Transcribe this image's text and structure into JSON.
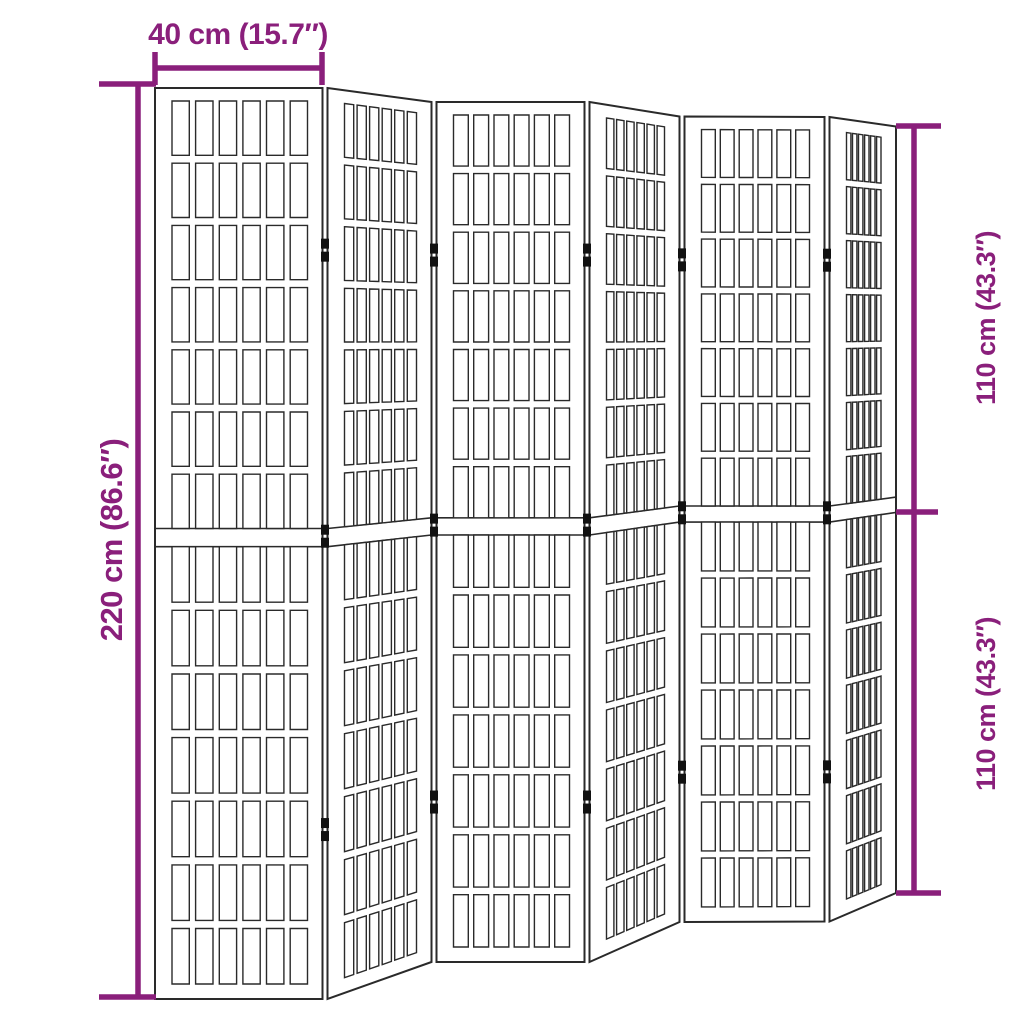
{
  "figure": {
    "title": "Room divider dimension diagram",
    "product": "Folding room divider, 6 panels, shoji lattice style",
    "background_color": "#ffffff",
    "line_color": "#2a2a2a",
    "accent_color": "#8a1f7b",
    "hinge_color": "#111111",
    "panel_count": 6,
    "hinges_per_junction": 3,
    "lattice": {
      "columns_per_panel": 6,
      "rows_per_half": 7,
      "halves_per_panel": 2
    }
  },
  "dimensions": {
    "width": {
      "label": "40 cm (15.7″)",
      "cm": 40,
      "inches": 15.7
    },
    "height_total": {
      "label": "220 cm (86.6″)",
      "cm": 220,
      "inches": 86.6
    },
    "height_upper": {
      "label": "110 cm (43.3″)",
      "cm": 110,
      "inches": 43.3
    },
    "height_lower": {
      "label": "110 cm (43.3″)",
      "cm": 110,
      "inches": 43.3
    }
  }
}
